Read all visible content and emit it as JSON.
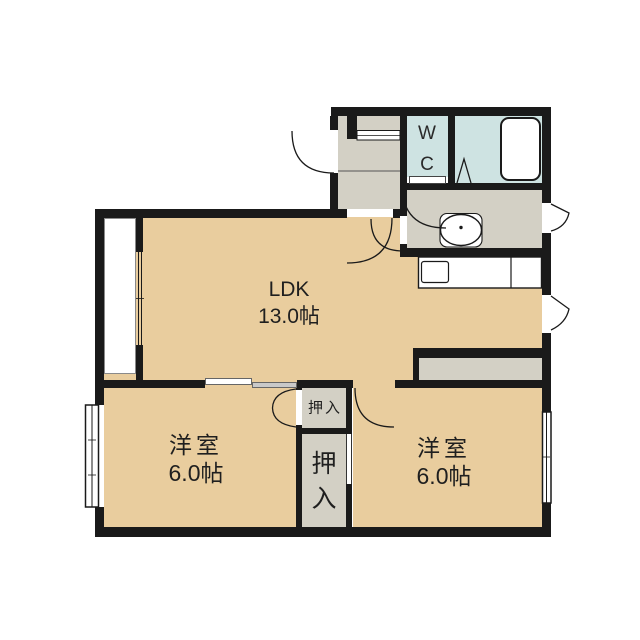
{
  "plan": {
    "rooms": {
      "ldk": {
        "name": "LDK",
        "area": "13.0帖"
      },
      "bedroom_left": {
        "name": "洋室",
        "area": "6.0帖"
      },
      "bedroom_right": {
        "name": "洋室",
        "area": "6.0帖"
      },
      "toilet": {
        "line1": "W",
        "line2": "C"
      },
      "closet_upper": {
        "name": "押入"
      },
      "closet_lower": {
        "char1": "押",
        "char2": "入"
      }
    },
    "colors": {
      "floor_tatami": "#e9cd9e",
      "service_gray": "#d3d0c5",
      "wet_blue": "#cee3e2",
      "wall_black": "#1a1a1a",
      "background": "#ffffff"
    },
    "fixtures": [
      "bathtub",
      "vanity-sink",
      "kitchen-counter",
      "kitchen-sink",
      "shoe-cabinet",
      "entry-step"
    ]
  }
}
